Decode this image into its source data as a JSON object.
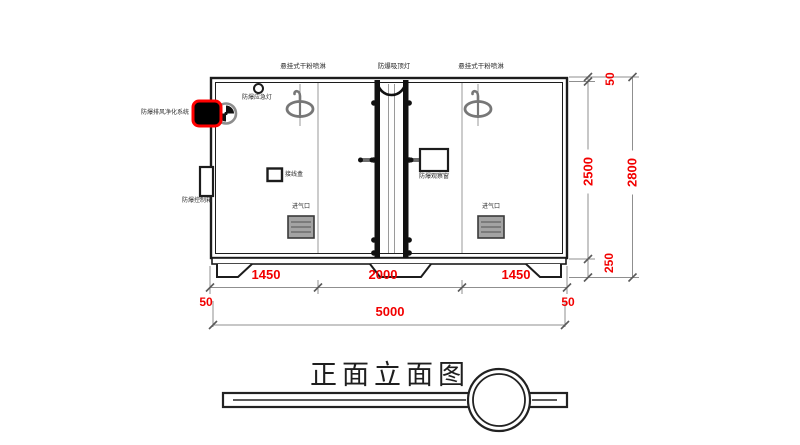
{
  "drawing": {
    "title": "正面立面图",
    "equipment_labels": {
      "sprinkler_left": "悬挂式干粉喷淋",
      "ceiling_lamp": "防爆吸顶灯",
      "sprinkler_right": "悬挂式干粉喷淋",
      "emergency_light": "防爆应急灯",
      "purifier_system": "防爆排风净化系统",
      "control_box": "防爆控制箱",
      "junction_box": "接线盒",
      "observation_window": "防爆观察窗",
      "air_inlet_left": "进气口",
      "air_inlet_right": "进气口"
    },
    "dimensions_mm": {
      "bottom_sections": [
        "1450",
        "2000",
        "1450"
      ],
      "bottom_wall_left": "50",
      "bottom_total": "5000",
      "bottom_wall_right": "50",
      "right_top": "50",
      "right_body": "2500",
      "right_base": "250",
      "right_total": "2800"
    },
    "colors": {
      "dimension_red": "#f20000",
      "line_black": "#1c1c1c",
      "dim_line_gray": "#8f8f8f",
      "device_highlight_red": "#ff0000",
      "sprinkler_gray": "#777777"
    }
  }
}
